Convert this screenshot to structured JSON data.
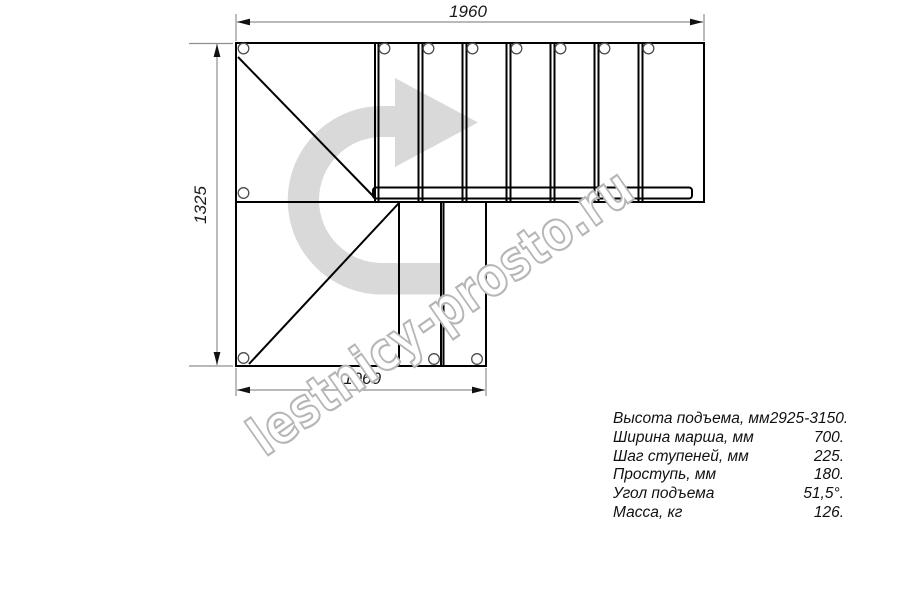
{
  "drawing": {
    "type": "staircase-plan-top-view",
    "dim_top": "1960",
    "dim_left": "1325",
    "dim_bottom": "1060",
    "watermark": "lestnicy-prosto.ru",
    "turn_arrow": "u-turn-right-arrow"
  },
  "specs": {
    "rows": [
      {
        "label": "Высота подъема, мм",
        "value": "2925-3150."
      },
      {
        "label": "Ширина марша, мм",
        "value": "700."
      },
      {
        "label": "Шаг ступеней, мм",
        "value": "225."
      },
      {
        "label": "Проступь, мм",
        "value": "180."
      },
      {
        "label": "Угол подъема",
        "value": "51,5°."
      },
      {
        "label": "Масса, кг",
        "value": "126."
      }
    ]
  },
  "colors": {
    "line": "#000000",
    "dimension_line": "#8f8f8f",
    "arrow_fill": "#d9d9d9",
    "watermark_outline": "#b6b6b6",
    "background": "#ffffff"
  }
}
